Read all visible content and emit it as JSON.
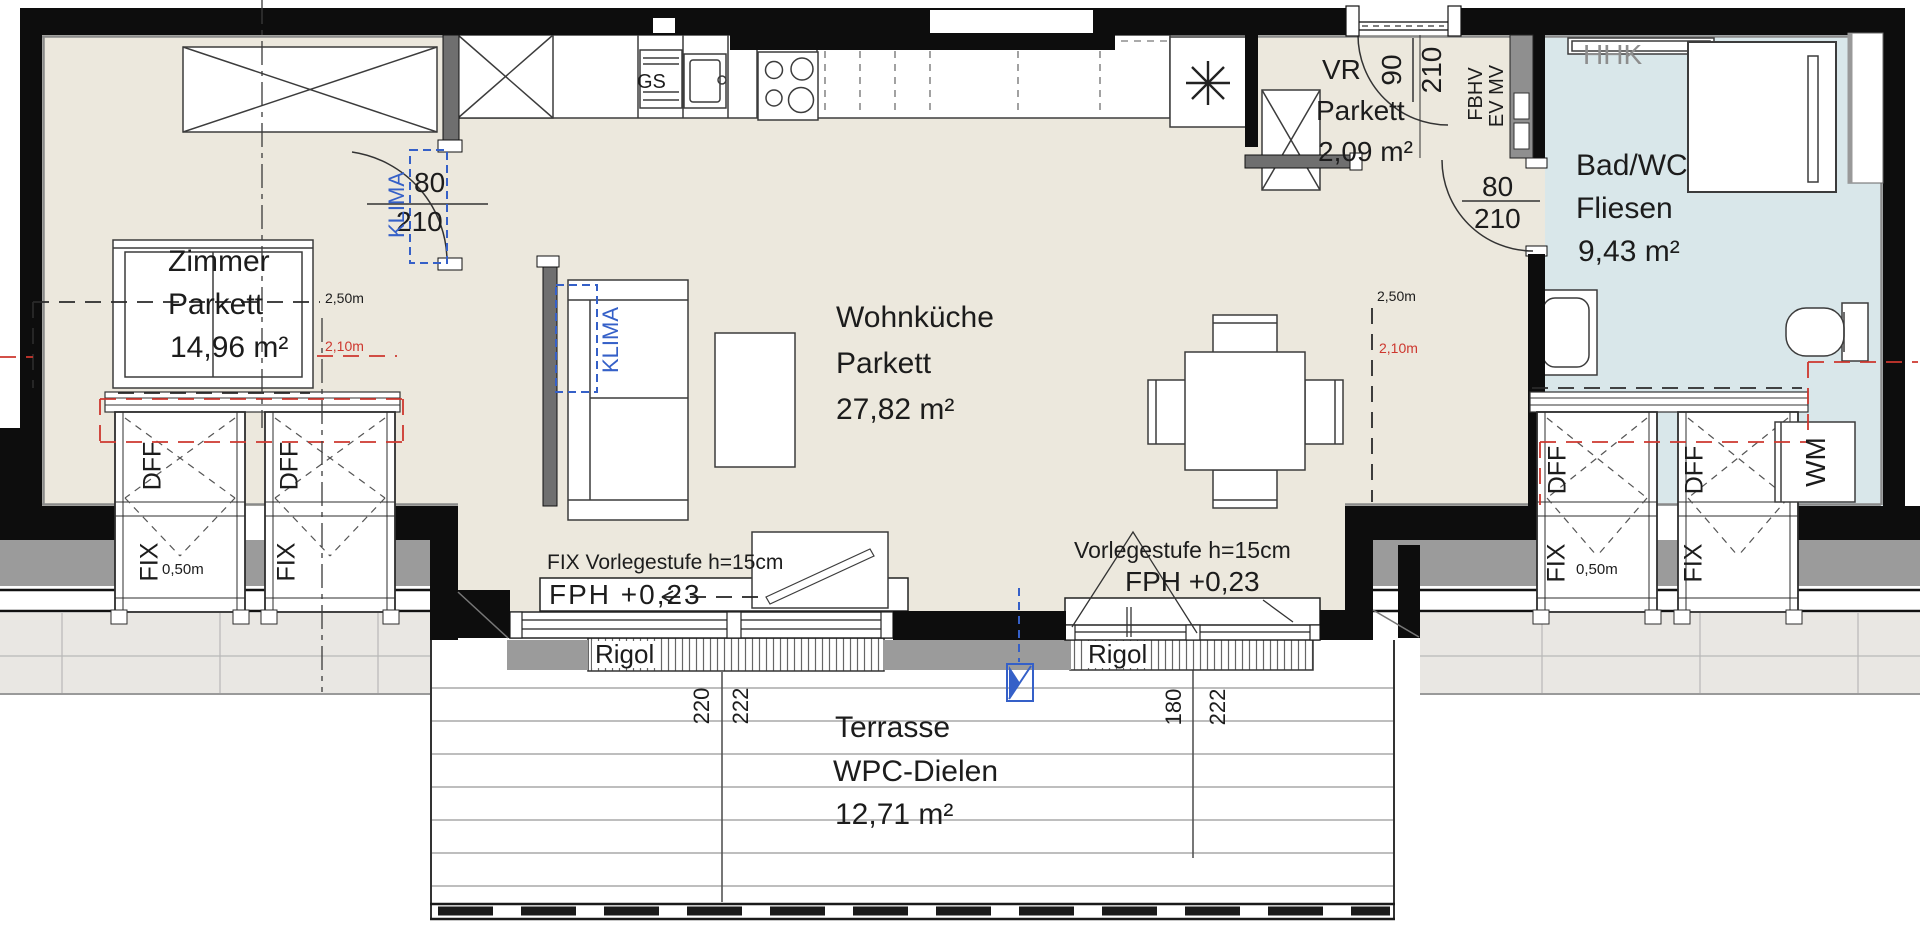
{
  "plan": {
    "rooms": {
      "zimmer": {
        "name": "Zimmer",
        "floor": "Parkett",
        "area": "14,96 m²"
      },
      "wohnkueche": {
        "name": "Wohnküche",
        "floor": "Parkett",
        "area": "27,82 m²"
      },
      "vorraum": {
        "name": "VR",
        "floor": "Parkett",
        "area": "2,09 m²"
      },
      "bad": {
        "name": "Bad/WC",
        "floor": "Fliesen",
        "area": "9,43 m²"
      },
      "terrasse": {
        "name": "Terrasse",
        "floor": "WPC-Dielen",
        "area": "12,71 m²"
      }
    },
    "doors": {
      "zimmer": {
        "w": "80",
        "h": "210"
      },
      "entrance": {
        "w": "90",
        "h": "210"
      },
      "bad": {
        "w": "80",
        "h": "210"
      }
    },
    "heights": {
      "h250": "2,50m",
      "h210": "2,10m"
    },
    "windows": {
      "dff": "DFF",
      "fix": "FIX",
      "fix_height": "0,50m"
    },
    "fixtures": {
      "gs": "GS",
      "hhk": "HHK",
      "wm": "WM",
      "fbhv": "FBHV",
      "ev_mv": "EV MV",
      "klima": "KLIMA"
    },
    "terrace_steps": {
      "step_fix": "FIX Vorlegestufe h=15cm",
      "step": "Vorlegestufe h=15cm",
      "fph": "FPH +0,23",
      "rigol": "Rigol"
    },
    "terrace_dims": {
      "left_a": "220",
      "left_b": "222",
      "right_a": "180",
      "right_b": "222"
    },
    "colors": {
      "floor": "#ece8dd",
      "bath": "#d9e7ea",
      "wall": "#0d0d0d",
      "accent_red": "#cd372e",
      "accent_blue": "#3560c8",
      "roof_gray": "#9b9b9b"
    }
  }
}
